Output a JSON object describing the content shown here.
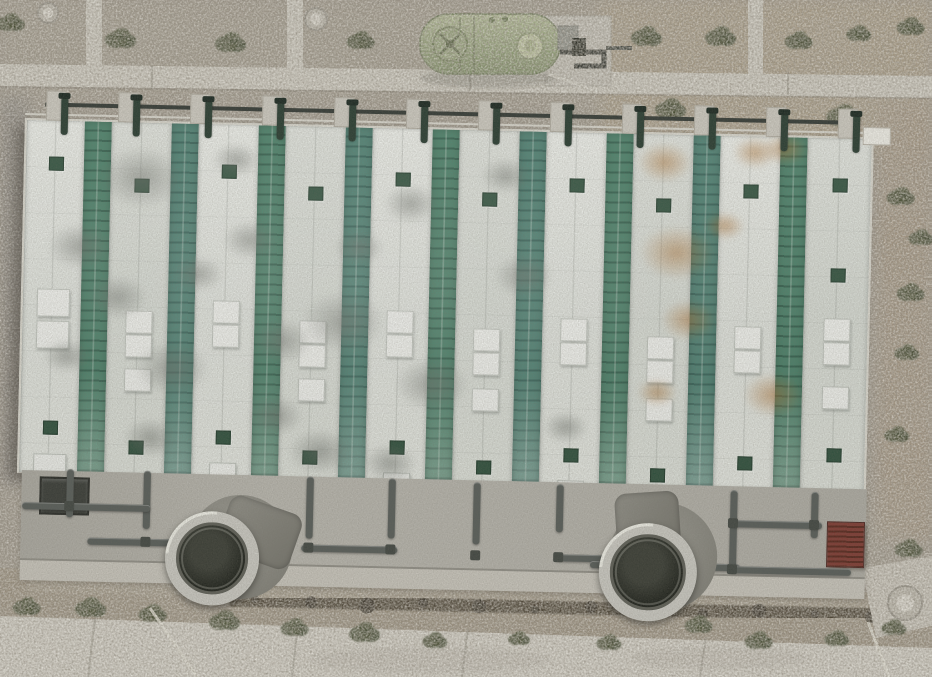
{
  "meta": {
    "description": "aerial-drone-photo-industrial-water-treatment-facility",
    "width": 932,
    "height": 677
  },
  "colors": {
    "gravel": "#9e978b",
    "roofWhite": "#e6e8e3",
    "roofGreen": "#4a8069",
    "greenLine": "#33604e",
    "walk": "#ccc9c0",
    "riser": "#2c3f34",
    "apron": "#b2b0a8",
    "curb": "#c5c2b9",
    "pipe": "#585d59",
    "ring": "#c7c6bf",
    "vent": "#31523f",
    "sky": "#f2f3ef",
    "box": "#3a3d38",
    "shrub1": "#454c33",
    "shrub2": "#384027",
    "trench": "#3f382b",
    "path": "#d3d0c6",
    "road": "#d7d4cb",
    "dirt": "#988d7b",
    "tank": "#a2ad84"
  },
  "scene": {
    "roof": {
      "stripes": [
        {
          "x": 0,
          "w": 58,
          "t": "wa"
        },
        {
          "x": 58,
          "w": 27,
          "t": "ga"
        },
        {
          "x": 85,
          "w": 60,
          "t": "wb"
        },
        {
          "x": 145,
          "w": 27,
          "t": "gb"
        },
        {
          "x": 172,
          "w": 60,
          "t": "wa"
        },
        {
          "x": 232,
          "w": 27,
          "t": "ga"
        },
        {
          "x": 259,
          "w": 60,
          "t": "wb"
        },
        {
          "x": 319,
          "w": 27,
          "t": "gb"
        },
        {
          "x": 346,
          "w": 60,
          "t": "wa"
        },
        {
          "x": 406,
          "w": 27,
          "t": "ga"
        },
        {
          "x": 433,
          "w": 60,
          "t": "wb"
        },
        {
          "x": 493,
          "w": 27,
          "t": "gb"
        },
        {
          "x": 520,
          "w": 60,
          "t": "wa"
        },
        {
          "x": 580,
          "w": 27,
          "t": "ga"
        },
        {
          "x": 607,
          "w": 60,
          "t": "wb"
        },
        {
          "x": 667,
          "w": 27,
          "t": "gb"
        },
        {
          "x": 694,
          "w": 60,
          "t": "wa"
        },
        {
          "x": 754,
          "w": 27,
          "t": "ga"
        },
        {
          "x": 781,
          "w": 64,
          "t": "wb"
        }
      ],
      "features": [
        [
          "v",
          23,
          36
        ],
        [
          "S",
          14,
          168
        ],
        [
          "S",
          14,
          200
        ],
        [
          "v",
          23,
          300
        ],
        [
          "S",
          14,
          333
        ],
        [
          "v",
          109,
          56
        ],
        [
          "s",
          103,
          188
        ],
        [
          "s",
          103,
          212
        ],
        [
          "v",
          109,
          318
        ],
        [
          "s",
          103,
          246
        ],
        [
          "v",
          196,
          40
        ],
        [
          "s",
          190,
          176
        ],
        [
          "s",
          190,
          200
        ],
        [
          "v",
          196,
          306
        ],
        [
          "s",
          190,
          338
        ],
        [
          "v",
          283,
          60
        ],
        [
          "s",
          277,
          194
        ],
        [
          "s",
          277,
          218
        ],
        [
          "v",
          283,
          324
        ],
        [
          "s",
          277,
          252
        ],
        [
          "v",
          370,
          44
        ],
        [
          "s",
          364,
          182
        ],
        [
          "s",
          364,
          206
        ],
        [
          "v",
          370,
          312
        ],
        [
          "s",
          364,
          344
        ],
        [
          "v",
          457,
          62
        ],
        [
          "s",
          451,
          198
        ],
        [
          "s",
          451,
          222
        ],
        [
          "v",
          457,
          330
        ],
        [
          "s",
          451,
          258
        ],
        [
          "v",
          544,
          46
        ],
        [
          "s",
          538,
          186
        ],
        [
          "s",
          538,
          210
        ],
        [
          "v",
          544,
          316
        ],
        [
          "s",
          538,
          348
        ],
        [
          "v",
          631,
          64
        ],
        [
          "s",
          625,
          202
        ],
        [
          "s",
          625,
          226
        ],
        [
          "v",
          631,
          334
        ],
        [
          "s",
          625,
          264
        ],
        [
          "v",
          718,
          48
        ],
        [
          "s",
          712,
          190
        ],
        [
          "s",
          712,
          214
        ],
        [
          "v",
          718,
          320
        ],
        [
          "s",
          712,
          352
        ],
        [
          "v",
          807,
          40
        ],
        [
          "s",
          801,
          180
        ],
        [
          "s",
          801,
          204
        ],
        [
          "v",
          807,
          310
        ],
        [
          "s",
          801,
          248
        ],
        [
          "v",
          807,
          130
        ]
      ],
      "stains": [
        [
          "g",
          115,
          55,
          85
        ],
        [
          "g",
          55,
          125,
          65
        ],
        [
          "g",
          150,
          245,
          75
        ],
        [
          "g",
          225,
          115,
          55
        ],
        [
          "g",
          320,
          195,
          85
        ],
        [
          "g",
          300,
          325,
          65
        ],
        [
          "g",
          385,
          75,
          55
        ],
        [
          "g",
          410,
          255,
          75
        ],
        [
          "g",
          500,
          145,
          60
        ],
        [
          "g",
          130,
          315,
          55
        ],
        [
          "g",
          45,
          235,
          48
        ],
        [
          "g",
          370,
          335,
          55
        ],
        [
          "g",
          545,
          295,
          45
        ],
        [
          "g",
          210,
          35,
          48
        ],
        [
          "g",
          260,
          215,
          60
        ],
        [
          "g",
          480,
          45,
          50
        ],
        [
          "g",
          95,
          175,
          60
        ],
        [
          "g",
          175,
          150,
          50
        ],
        [
          "g",
          255,
          290,
          55
        ],
        [
          "g",
          335,
          120,
          50
        ],
        [
          "r",
          638,
          28,
          55
        ],
        [
          "r",
          652,
          118,
          75
        ],
        [
          "r",
          665,
          185,
          55
        ],
        [
          "r",
          728,
          16,
          45
        ],
        [
          "r",
          752,
          258,
          60
        ],
        [
          "r",
          636,
          258,
          40
        ],
        [
          "r",
          758,
          12,
          45
        ],
        [
          "r",
          700,
          90,
          40
        ]
      ]
    },
    "walkway": {
      "teeth": [
        30,
        102,
        174,
        246,
        318,
        390,
        462,
        534,
        606,
        678,
        750,
        822
      ]
    },
    "apron": {
      "pipes": [
        [
          50,
          350,
          7,
          48
        ],
        [
          127,
          350,
          7,
          58
        ],
        [
          290,
          352,
          7,
          62
        ],
        [
          372,
          352,
          7,
          60
        ],
        [
          457,
          354,
          7,
          62
        ],
        [
          540,
          354,
          7,
          48
        ],
        [
          714,
          356,
          7,
          78
        ],
        [
          795,
          356,
          7,
          46
        ],
        [
          6,
          384,
          128,
          7
        ],
        [
          72,
          418,
          92,
          7
        ],
        [
          286,
          420,
          96,
          7
        ],
        [
          540,
          424,
          80,
          7
        ],
        [
          575,
          430,
          150,
          7
        ],
        [
          714,
          386,
          92,
          7
        ],
        [
          714,
          432,
          122,
          7
        ]
      ],
      "elbows": [
        [
          48,
          382
        ],
        [
          125,
          416
        ],
        [
          288,
          418
        ],
        [
          370,
          418
        ],
        [
          455,
          422
        ],
        [
          538,
          422
        ],
        [
          712,
          384
        ],
        [
          712,
          430
        ],
        [
          793,
          384
        ]
      ],
      "fans": [
        {
          "cx": 197,
          "cy": 436,
          "r": 36,
          "back": [
            225,
            424,
            52
          ],
          "case": [
            206,
            380,
            76,
            58,
            18
          ]
        },
        {
          "cx": 633,
          "cy": 440,
          "r": 38,
          "back": [
            648,
            424,
            54
          ],
          "case": [
            600,
            360,
            64,
            66,
            -5
          ]
        }
      ],
      "box": {
        "x": 23,
        "y": 358,
        "w": 46,
        "h": 34
      },
      "grate": {
        "x": 811,
        "y": 385,
        "w": 36,
        "h": 44
      }
    },
    "ground": {
      "shrubs": [
        [
          122,
          38,
          1
        ],
        [
          232,
          42,
          1
        ],
        [
          362,
          40,
          0.9
        ],
        [
          648,
          36,
          1
        ],
        [
          722,
          36,
          1
        ],
        [
          800,
          40,
          0.9
        ],
        [
          860,
          33,
          0.8
        ],
        [
          912,
          26,
          0.9
        ],
        [
          672,
          108,
          1
        ],
        [
          845,
          115,
          1.1
        ],
        [
          902,
          196,
          0.9
        ],
        [
          922,
          237,
          0.8
        ],
        [
          912,
          292,
          0.9
        ],
        [
          908,
          352,
          0.8
        ],
        [
          898,
          434,
          0.8
        ],
        [
          910,
          548,
          0.9
        ],
        [
          12,
          22,
          0.9
        ],
        [
          28,
          606,
          0.9
        ],
        [
          92,
          607,
          1
        ],
        [
          154,
          613,
          0.9
        ],
        [
          226,
          620,
          1
        ],
        [
          296,
          627,
          0.9
        ],
        [
          366,
          632,
          1
        ],
        [
          436,
          640,
          0.8
        ],
        [
          520,
          638,
          0.7
        ],
        [
          610,
          642,
          0.8
        ],
        [
          700,
          624,
          0.9
        ],
        [
          760,
          640,
          0.9
        ],
        [
          838,
          638,
          0.8
        ],
        [
          895,
          627,
          0.8
        ]
      ],
      "manholes": [
        [
          48,
          13,
          10
        ],
        [
          316,
          19,
          11
        ],
        [
          905,
          603,
          17
        ]
      ],
      "white_lines": [
        [
          150,
          608,
          197,
          677
        ],
        [
          868,
          622,
          889,
          677
        ]
      ],
      "joints": [
        [
          95,
          619,
          88,
          677
        ],
        [
          298,
          624,
          292,
          677
        ],
        [
          468,
          629,
          462,
          677
        ],
        [
          706,
          637,
          700,
          677
        ],
        [
          152,
          66,
          152,
          89
        ],
        [
          470,
          68,
          470,
          91
        ],
        [
          788,
          72,
          788,
          95
        ]
      ]
    }
  }
}
